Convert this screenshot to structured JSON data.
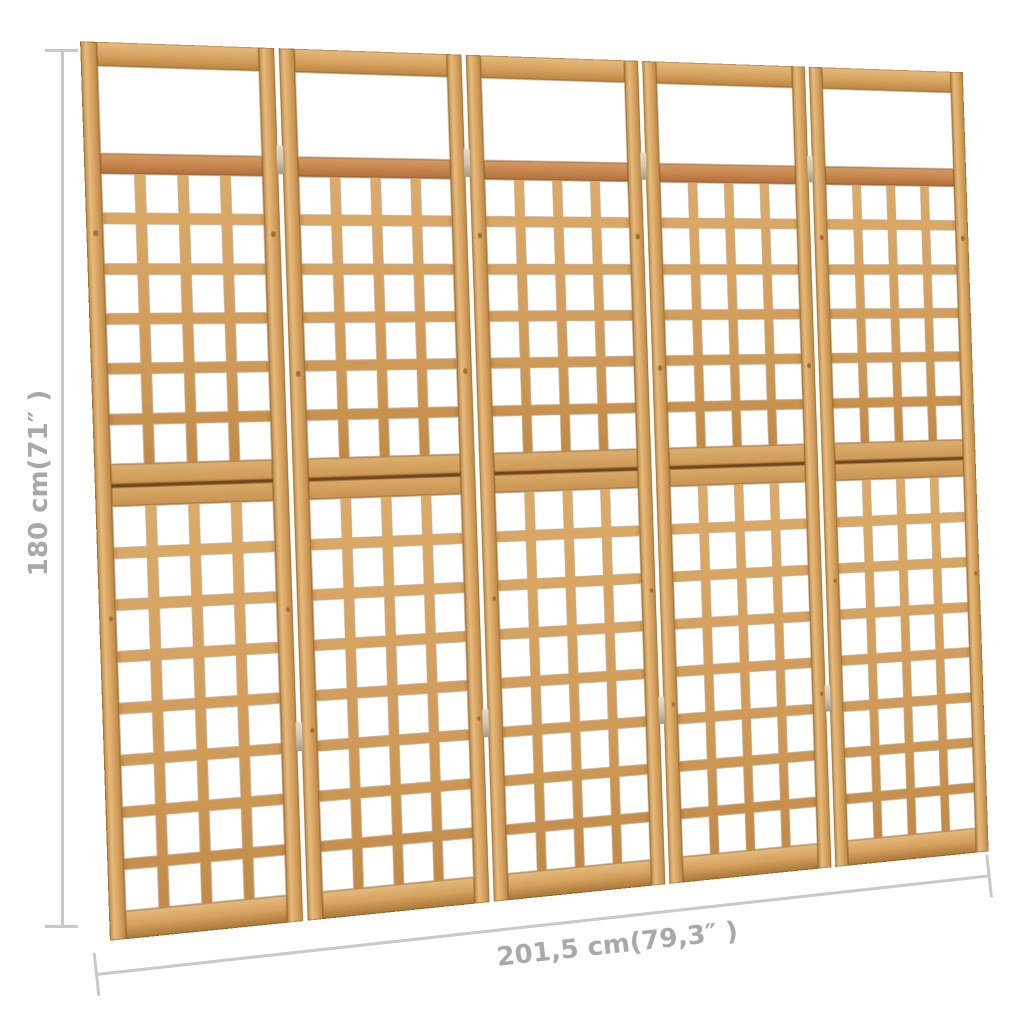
{
  "product": {
    "name": "5-panel wooden trellis room divider",
    "panel_count": 5,
    "upper_lattice": {
      "rows": 6,
      "cols": 4
    },
    "lower_lattice": {
      "rows": 8,
      "cols": 4
    },
    "hinges_per_joint": 2
  },
  "dimensions": {
    "height_label": "180 cm(71″ )",
    "width_label": "201,5 cm(79,3″ )"
  },
  "colors": {
    "wood_base": "#d6a15f",
    "wood_light": "#e6bb7d",
    "wood_dark": "#b9853f",
    "accent_rail": "#c98950",
    "seam": "#6e4720",
    "hinge": "#cfc8ba",
    "hole": "#ffffff",
    "dimension_line": "#c9c9c9",
    "dimension_text": "#a8a8a8",
    "background": "#ffffff"
  }
}
